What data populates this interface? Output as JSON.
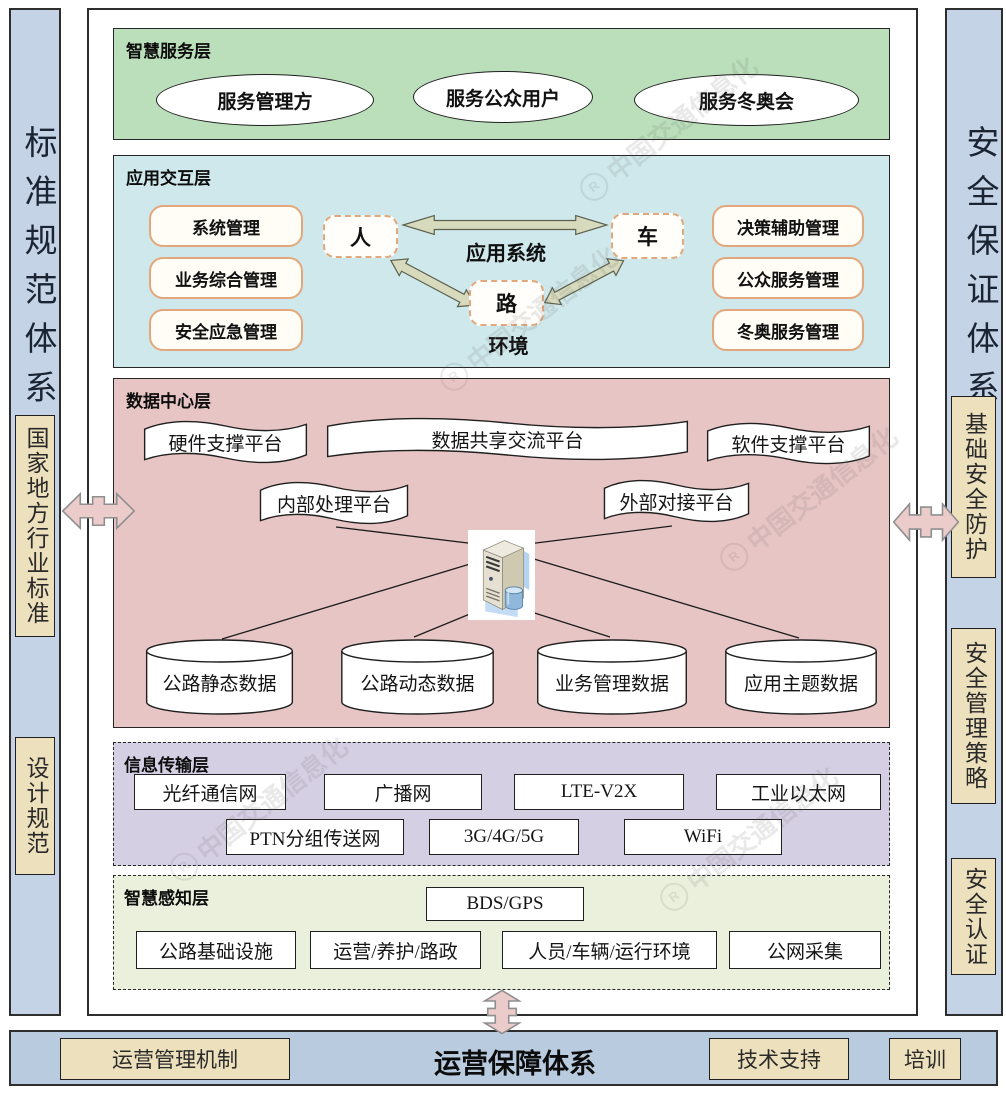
{
  "watermark": {
    "text": "中国交通信息化",
    "logo": "R"
  },
  "left_sidebar": {
    "title": "标准规范体系",
    "items": [
      "国家地方行业标准",
      "设计规范"
    ]
  },
  "right_sidebar": {
    "title": "安全保证体系",
    "items": [
      "基础安全防护",
      "安全管理策略",
      "安全认证"
    ]
  },
  "layers": {
    "service": {
      "label": "智慧服务层",
      "ellipses": [
        "服务管理方",
        "服务公众用户",
        "服务冬奥会"
      ]
    },
    "interaction": {
      "label": "应用交互层",
      "left_boxes": [
        "系统管理",
        "业务综合管理",
        "安全应急管理"
      ],
      "right_boxes": [
        "决策辅助管理",
        "公众服务管理",
        "冬奥服务管理"
      ],
      "node_person": "人",
      "node_vehicle": "车",
      "node_road": "路",
      "center_label": "应用系统",
      "env_label": "环境"
    },
    "data_center": {
      "label": "数据中心层",
      "banners": [
        "硬件支撑平台",
        "数据共享交流平台",
        "软件支撑平台",
        "内部处理平台",
        "外部对接平台"
      ],
      "cylinders": [
        "公路静态数据",
        "公路动态数据",
        "业务管理数据",
        "应用主题数据"
      ]
    },
    "transmission": {
      "label": "信息传输层",
      "row1": [
        "光纤通信网",
        "广播网",
        "LTE-V2X",
        "工业以太网"
      ],
      "row2": [
        "PTN分组传送网",
        "3G/4G/5G",
        "WiFi"
      ]
    },
    "perception": {
      "label": "智慧感知层",
      "gnss_box": "BDS/GPS",
      "boxes": [
        "公路基础设施",
        "运营/养护/路政",
        "人员/车辆/运行环境",
        "公网采集"
      ]
    }
  },
  "bottom_bar": {
    "title": "运营保障体系",
    "left_item": "运营管理机制",
    "right_items": [
      "技术支持",
      "培训"
    ]
  },
  "colors": {
    "service_bg": "#badfba",
    "interaction_bg": "#cfe8ec",
    "data_bg": "#e7c5c4",
    "transmission_bg": "#d5cfe3",
    "perception_bg": "#eaf0dc",
    "sidebar_bg": "#c4d3e6",
    "bottom_bar_bg": "#b9cbdf",
    "tan_box_bg": "#ede0bc",
    "orange_border": "#e2a87c",
    "olive_arrow": "#d7dabc",
    "pink_arrow": "#eccccb"
  }
}
